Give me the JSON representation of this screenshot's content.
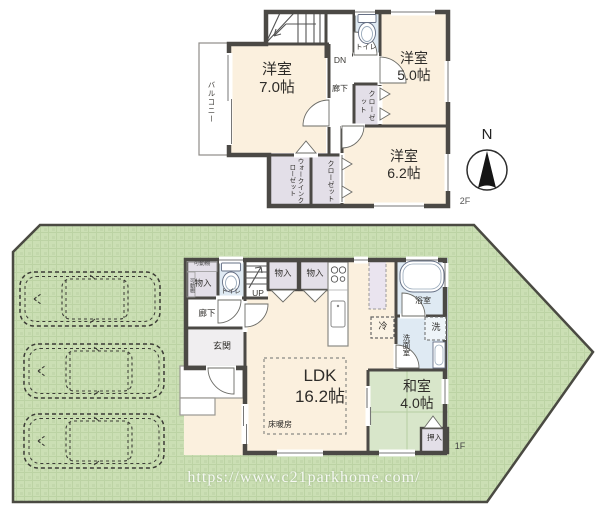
{
  "watermark": {
    "url": "https://www.c21parkhome.com/"
  },
  "compass": {
    "north": "N"
  },
  "floor2": {
    "label": "2F",
    "balcony": "バルコニー",
    "room_a_name": "洋室",
    "room_a_size": "7.0帖",
    "room_b_name": "洋室",
    "room_b_size": "5.0帖",
    "room_c_name": "洋室",
    "room_c_size": "6.2帖",
    "toilet": "トイレ",
    "hallway": "廊下",
    "stairs_down": "DN",
    "closet_mid": "クローゼット",
    "walk_in_closet": "ウォークインクローゼット",
    "closet_bottom": "クローゼット"
  },
  "floor1": {
    "label": "1F",
    "ldk_name": "LDK",
    "ldk_size": "16.2帖",
    "floor_heating": "床暖房",
    "washitsu_name": "和室",
    "washitsu_size": "4.0帖",
    "oshiire": "押入",
    "genkan": "玄関",
    "hallway": "廊下",
    "toilet": "トイレ",
    "stairs_up": "UP",
    "storage_a": "物入",
    "storage_b": "物入",
    "storage_c": "物入",
    "shelf_top": "可動棚",
    "shelf_side": "可動棚",
    "bath": "浴室",
    "washroom": "洗面室",
    "washer": "洗",
    "fridge": "冷"
  },
  "colors": {
    "lot_green": "#cbdfb4",
    "wall": "#4b4945",
    "room_cream": "#fbf0de",
    "closet_mauve": "#e3dfe8",
    "wet_area_blue": "#dfeaf3",
    "tatami_green": "#d8e6ca"
  }
}
